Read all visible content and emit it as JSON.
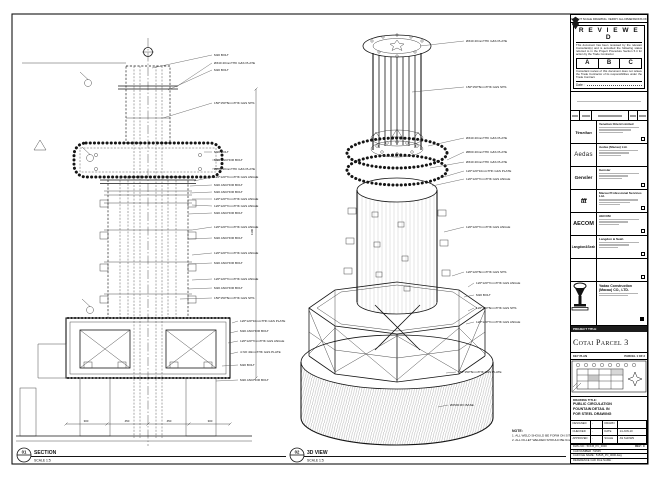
{
  "edge_note": "DO NOT SCALE DRAWING. VERIFY ALL DIMENSIONS ON SITE.",
  "stamp": {
    "title": "R E V I E W E D",
    "para1": "This document has been reviewed by the relevant Consultant(s) and is accorded the following status referred to in the Project Procedure Section 5.4 for action by the Trade Contractor.",
    "options": [
      "A",
      "B",
      "C"
    ],
    "para2": "Consultant review of this document does not relieve the Trade Contractor of its responsibilities under the Trade Contract.",
    "date_label": "Date :"
  },
  "consultants": [
    {
      "logo": "Venetian",
      "name": "Venetian Orient Limited"
    },
    {
      "logo": "Aedas",
      "name": "Aedas (Macau) Ltd."
    },
    {
      "logo": "Gensler",
      "name": "Gensler"
    },
    {
      "logo": "ttt",
      "name": "Macau Professional Services Ltd."
    },
    {
      "logo": "AECOM",
      "name": "AECOM"
    },
    {
      "logo": "Langdon&Seah",
      "name": "Langdon & Seah"
    },
    {
      "logo": "",
      "name": ""
    }
  ],
  "contractor": {
    "name_line1": "Yadao Construction",
    "name_line2": "(Macau) CO., LTD."
  },
  "project": {
    "label": "PROJECT TITLE",
    "title": "Cotai Parcel 3"
  },
  "key_plan": {
    "label": "KEY PLAN",
    "parcel": "PARCEL 1 OF 3"
  },
  "drawing_title": {
    "label": "DRAWING TITLE:",
    "lines": [
      "PUBLIC CIRCULATION",
      "FOUNTAIN DETAIL IN",
      "FOR STEEL DRAWING"
    ]
  },
  "signoff": {
    "rows": [
      [
        "DESIGNED",
        "-",
        "DRAWN",
        ""
      ],
      [
        "CHECKED",
        "-",
        "DATE",
        "14-JUN-10"
      ],
      [
        "APPROVED",
        "-",
        "SCALE",
        "AS SHOWN"
      ]
    ]
  },
  "refs": {
    "dwg_no": "DWG NO : 51545_PC_0000",
    "rev": "REV : C",
    "cad_number": "CAD NUMBER : 51545",
    "cad_file": "CAD FILE NAME : 51545_PC_0000.dwg",
    "ref_file": "REFERENCE CAD FILE NAME :"
  },
  "section": {
    "bubble": "01",
    "title": "SECTION",
    "scale": "SCALE 1:5",
    "labels": [
      "M20 BOLT",
      "Ø340 40mmTHK G&S PLATE",
      "M20 BOLT",
      "150*150*8mmTHK G&S SHS",
      "M20 BOLT",
      "M20 ANCHOR BOLT",
      "Ø800 40mmTHK G&S PLATE",
      "120*120*7mmTHK G&S ANGLE",
      "M20 ANCHOR BOLT",
      "M20 ANCHOR BOLT",
      "120*120*7mmTHK G&S ANGLE",
      "120*120*7mmTHK G&S ANGLE",
      "M20 ANCHOR BOLT",
      "120*120*7mmTHK G&S ANGLE",
      "M20 ANCHOR BOLT",
      "120*120*7mmTHK G&S ANGLE",
      "M20 ANCHOR BOLT",
      "120*120*7mmTHK G&S ANGLE",
      "M20 ANCHOR BOLT",
      "150*150*8mmTHK G&S SHS",
      "120*120*10mmTHK G&S PLATE",
      "M20 ANCHOR BOLT",
      "120*120*7mmTHK G&S ANGLE",
      "4 NO 40mmTHK G&S PLATE",
      "M20 BOLT",
      "M20 ANCHOR BOLT"
    ],
    "dims": {
      "bottom": [
        "300",
        "450",
        "450",
        "300"
      ],
      "vertical": "1100"
    }
  },
  "view3d": {
    "bubble": "02",
    "title": "3D VIEW",
    "scale": "SCALE 1:5",
    "labels": [
      "Ø340 40mmTHK G&S PLATE",
      "150*150*8mmTHK G&S SHS",
      "Ø340 40mmTHK G&S PLATE",
      "Ø800 40mmTHK G&S PLATE",
      "Ø340 40mmTHK G&S PLATE",
      "120*120*10mmTHK G&S PLATE",
      "120*120*7mmTHK G&S ANGLE",
      "120*120*7mmTHK G&S ANGLE",
      "120*120*8mmTHK G&S SHS",
      "120*120*7mmTHK G&S ANGLE",
      "M20 BOLT",
      "120*120*8mmTHK G&S SHS",
      "120*120*7mmTHK G&S ANGLE",
      "150*150*8mmTHK G&S PLATE",
      "Ø2500 RC BASE"
    ]
  },
  "note": {
    "title": "NOTE:",
    "lines": [
      "1. ALL WELD SHOULD BE FORM ON SITE.",
      "2. ALL FILLET WELDED SHOULD BE 6mm THK."
    ]
  }
}
